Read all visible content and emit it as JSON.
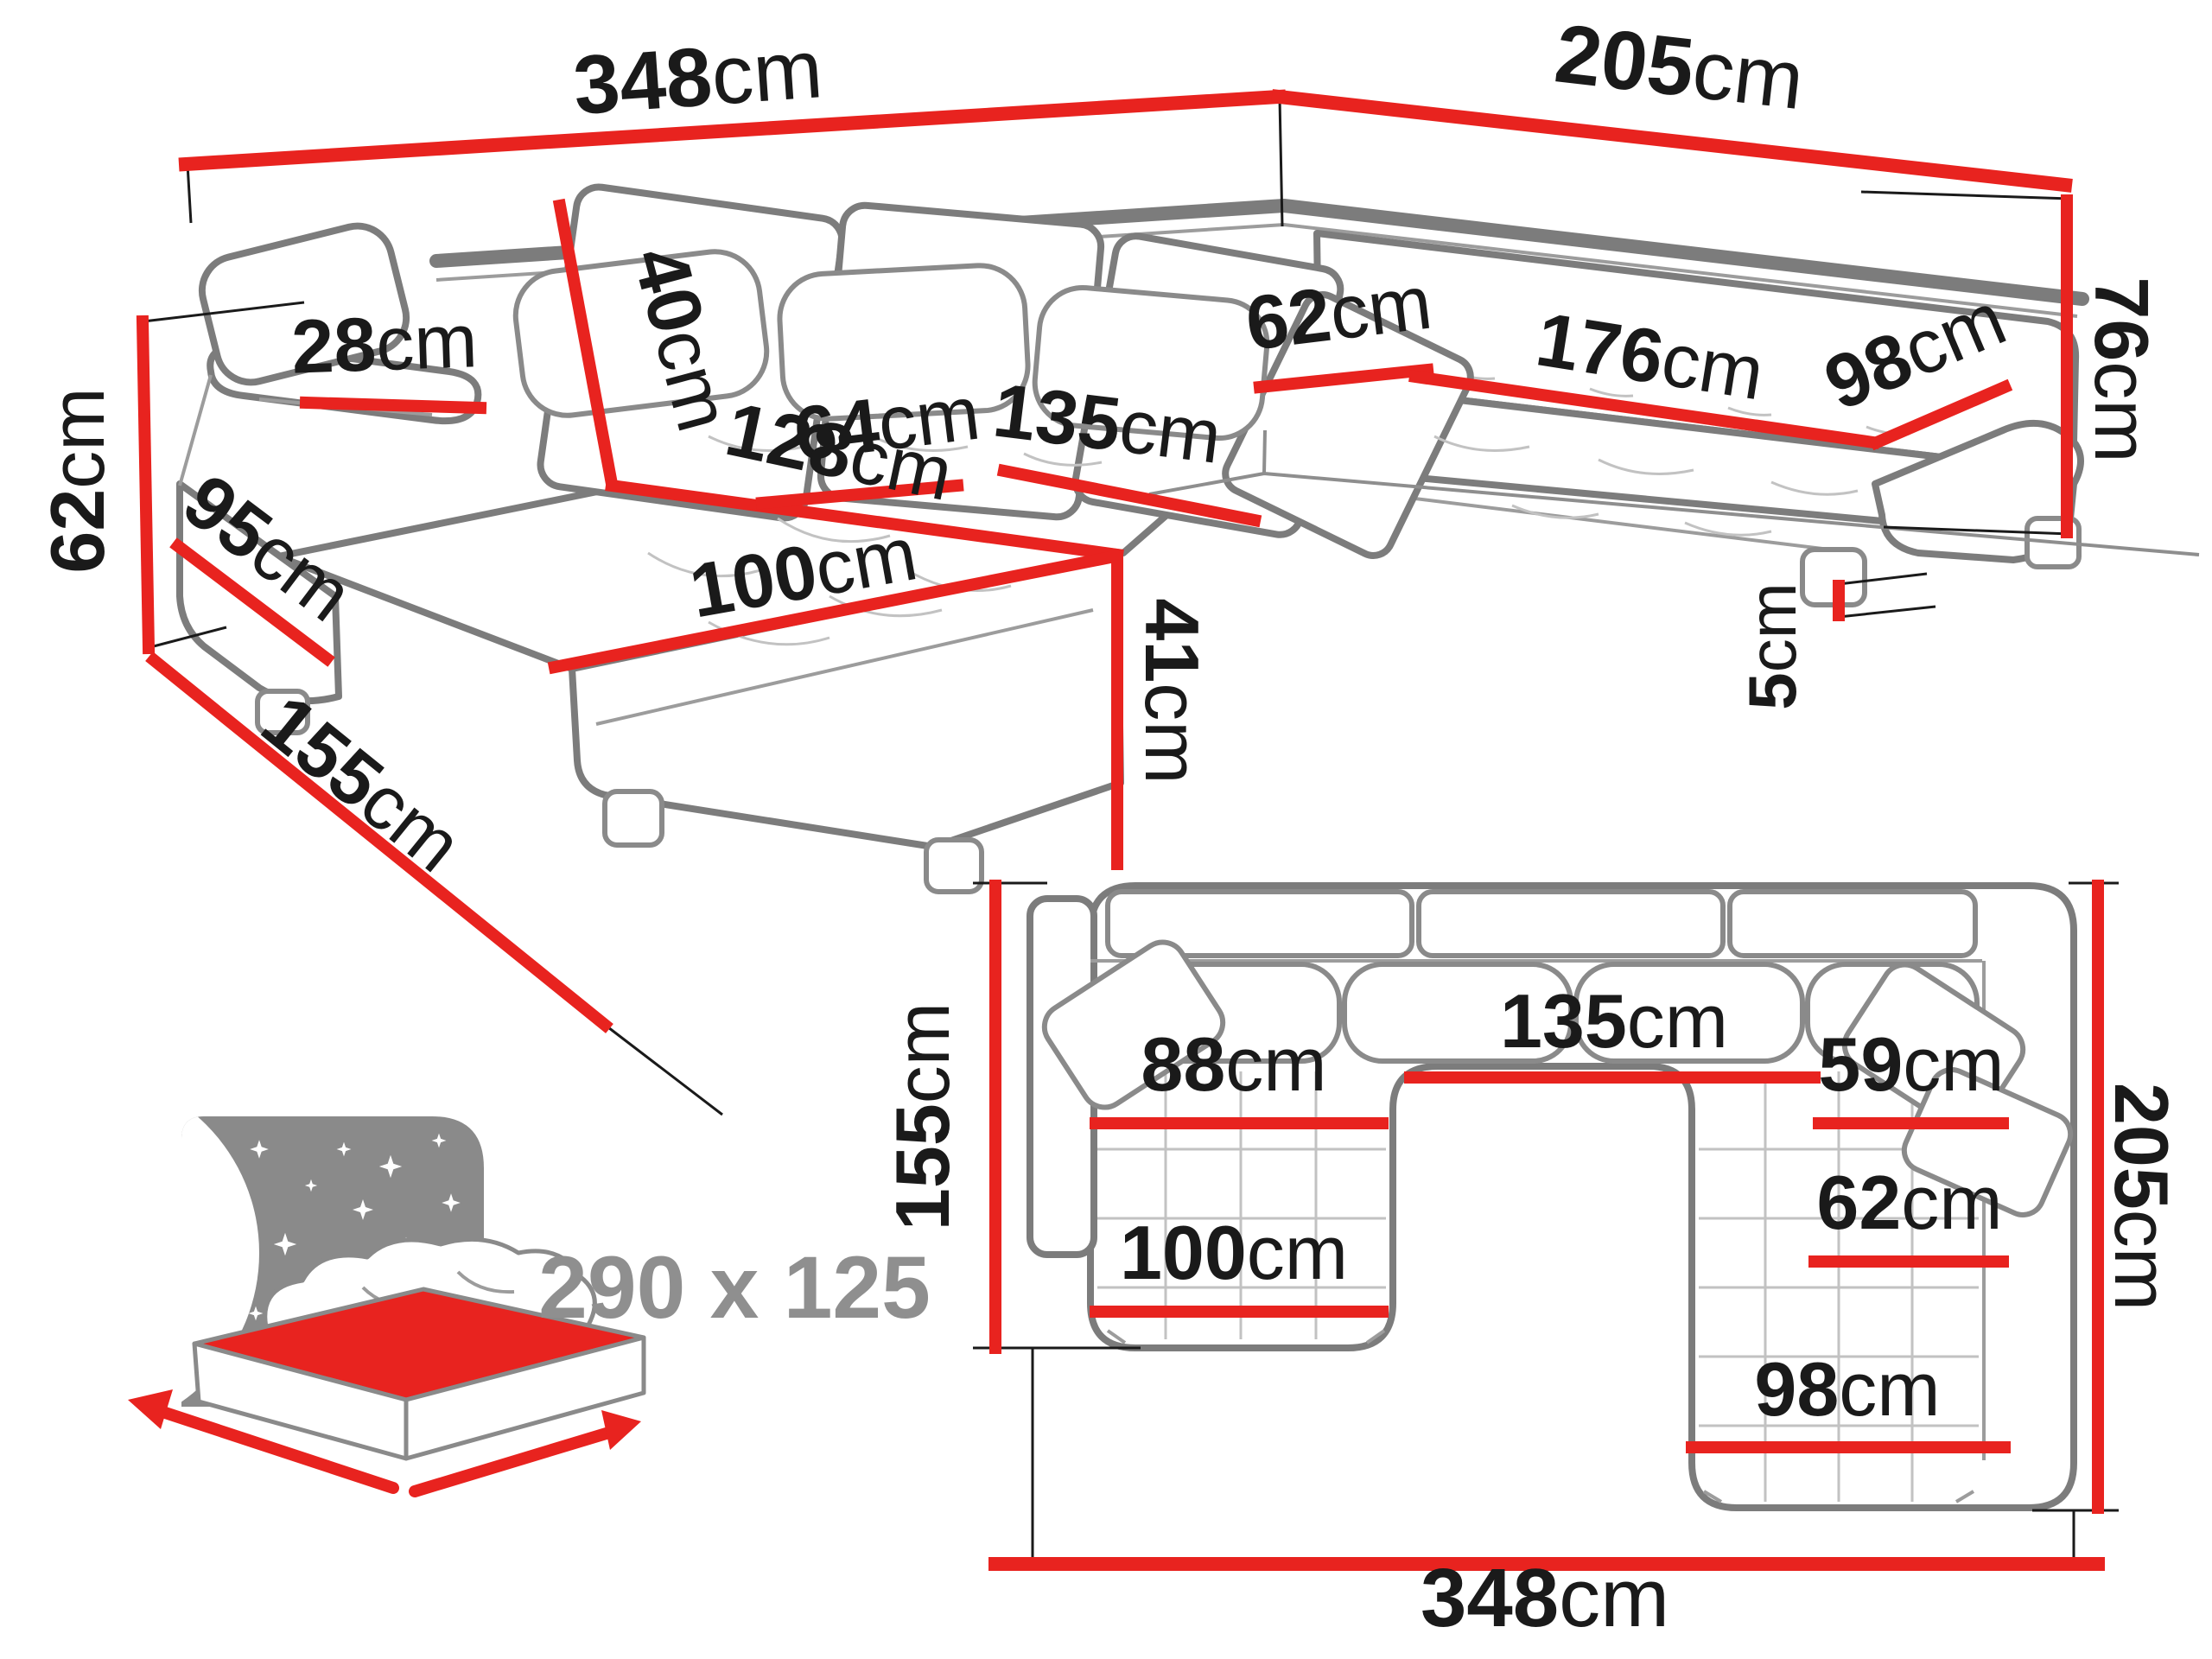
{
  "diagram": {
    "subject": "u-shaped-corner-sofa-dimension-drawing",
    "unit": "cm",
    "colors": {
      "dimension_line": "#e8231f",
      "outline": "#7c7c7c",
      "label_text": "#1a1a1a",
      "muted_text": "#8f8f8f"
    }
  },
  "perspective_view": {
    "back_width": {
      "num": "348",
      "unit": "cm"
    },
    "right_length": {
      "num": "205",
      "unit": "cm"
    },
    "total_height": {
      "num": "76",
      "unit": "cm"
    },
    "armrest_height": {
      "num": "62",
      "unit": "cm"
    },
    "chaise_depth": {
      "num": "155",
      "unit": "cm"
    },
    "armrest_front_length": {
      "num": "95",
      "unit": "cm"
    },
    "armrest_top_width": {
      "num": "28",
      "unit": "cm"
    },
    "back_cushion_height": {
      "num": "40",
      "unit": "cm"
    },
    "seat_depth": {
      "num": "64",
      "unit": "cm"
    },
    "center_seat_width": {
      "num": "135",
      "unit": "cm"
    },
    "chaise_length": {
      "num": "128",
      "unit": "cm"
    },
    "chaise_width": {
      "num": "100",
      "unit": "cm"
    },
    "seat_height": {
      "num": "41",
      "unit": "cm"
    },
    "right_seat_depth": {
      "num": "62",
      "unit": "cm"
    },
    "right_seat_length": {
      "num": "176",
      "unit": "cm"
    },
    "corner_seat_width": {
      "num": "98",
      "unit": "cm"
    },
    "leg_height": {
      "num": "5",
      "unit": "cm"
    }
  },
  "plan_view": {
    "chaise_depth": {
      "num": "155",
      "unit": "cm"
    },
    "total_depth": {
      "num": "205",
      "unit": "cm"
    },
    "chaise_seat_width": {
      "num": "88",
      "unit": "cm"
    },
    "center_seat_width": {
      "num": "135",
      "unit": "cm"
    },
    "right_seat_depth_upper": {
      "num": "59",
      "unit": "cm"
    },
    "right_seat_depth_lower": {
      "num": "62",
      "unit": "cm"
    },
    "chaise_width": {
      "num": "100",
      "unit": "cm"
    },
    "corner_seat_width": {
      "num": "98",
      "unit": "cm"
    },
    "total_width": {
      "num": "348",
      "unit": "cm"
    }
  },
  "sleeping_function": {
    "label": "290 x 125",
    "length_cm": 290,
    "width_cm": 125
  }
}
